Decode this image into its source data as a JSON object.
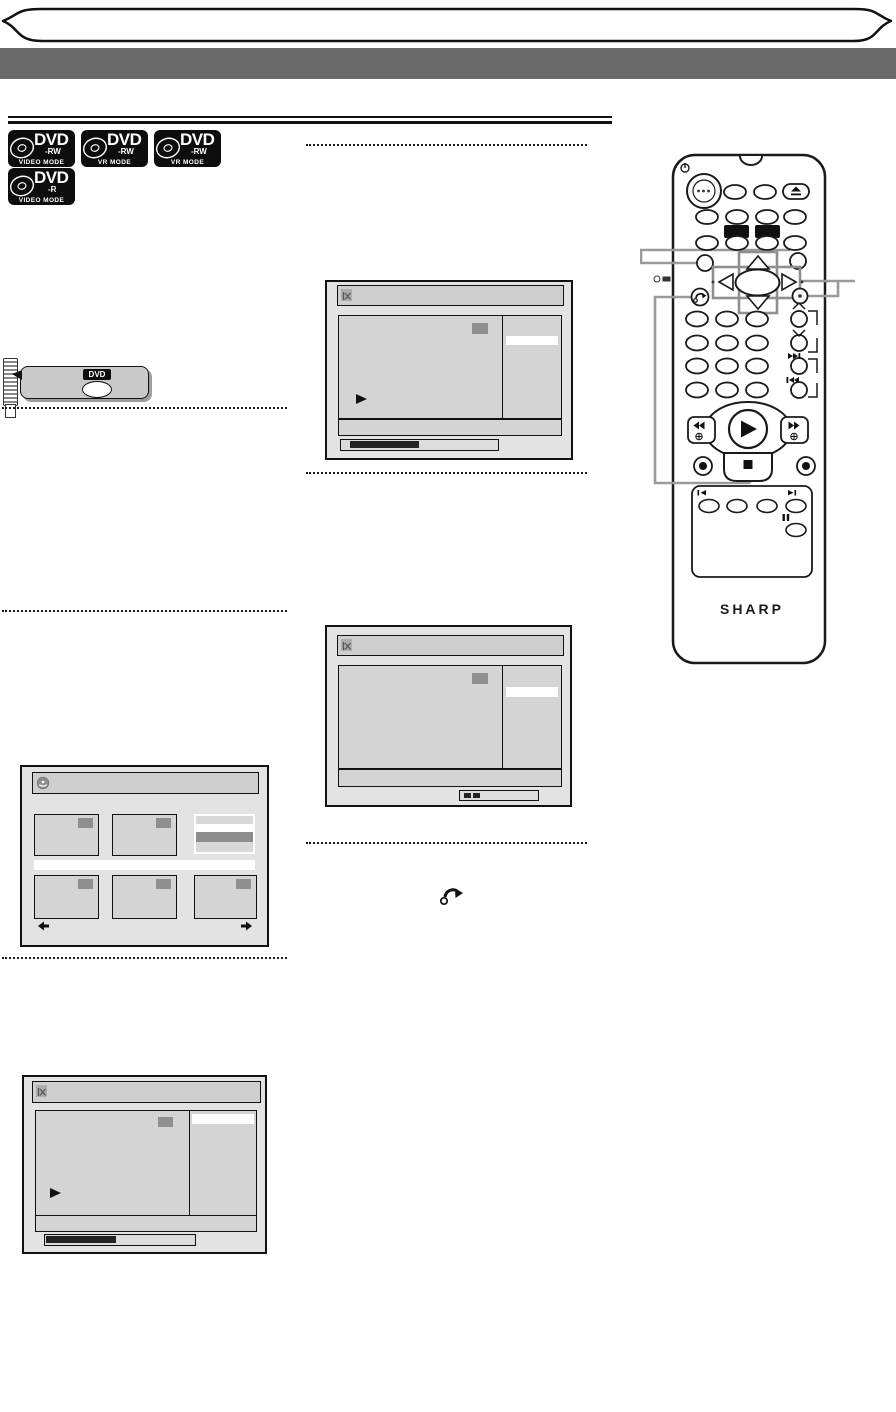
{
  "page": {
    "type": "dvd-recorder-manual-page"
  },
  "media_badges": [
    {
      "brand": "DVD",
      "variant": "-RW",
      "mode": "VIDEO MODE"
    },
    {
      "brand": "DVD",
      "variant": "-RW",
      "mode": "VR MODE"
    },
    {
      "brand": "DVD",
      "variant": "-RW",
      "mode": "VR MODE"
    },
    {
      "brand": "DVD",
      "variant": "-R",
      "mode": "VIDEO MODE"
    }
  ],
  "remote_callout": {
    "button_label": "DVD"
  },
  "remote": {
    "brand_logo": "SHARP"
  },
  "icons": {
    "edit_icon": "scissors-x glyph",
    "disc_icon": "disc",
    "play_icon": "right-triangle",
    "return_icon": "curved-arrow",
    "eject_icon": "triangle-over-bar",
    "power_icon": "power-circle",
    "pause_icon": "double-bar",
    "record_icon": "dot-in-circle",
    "stop_icon": "square",
    "prev_page_icon": "left-arrow",
    "next_page_icon": "right-arrow"
  },
  "colors": {
    "page_title_bar": "#696969",
    "osd_background": "#e3e3e3",
    "osd_panel": "#d4d4d4",
    "highlight_row": "#ffffff",
    "thumbnail_tag": "#8f8f8f",
    "progress_fill": "#242424",
    "callout_line": "#9a9a9a",
    "badge_background": "#0d0d0d"
  }
}
